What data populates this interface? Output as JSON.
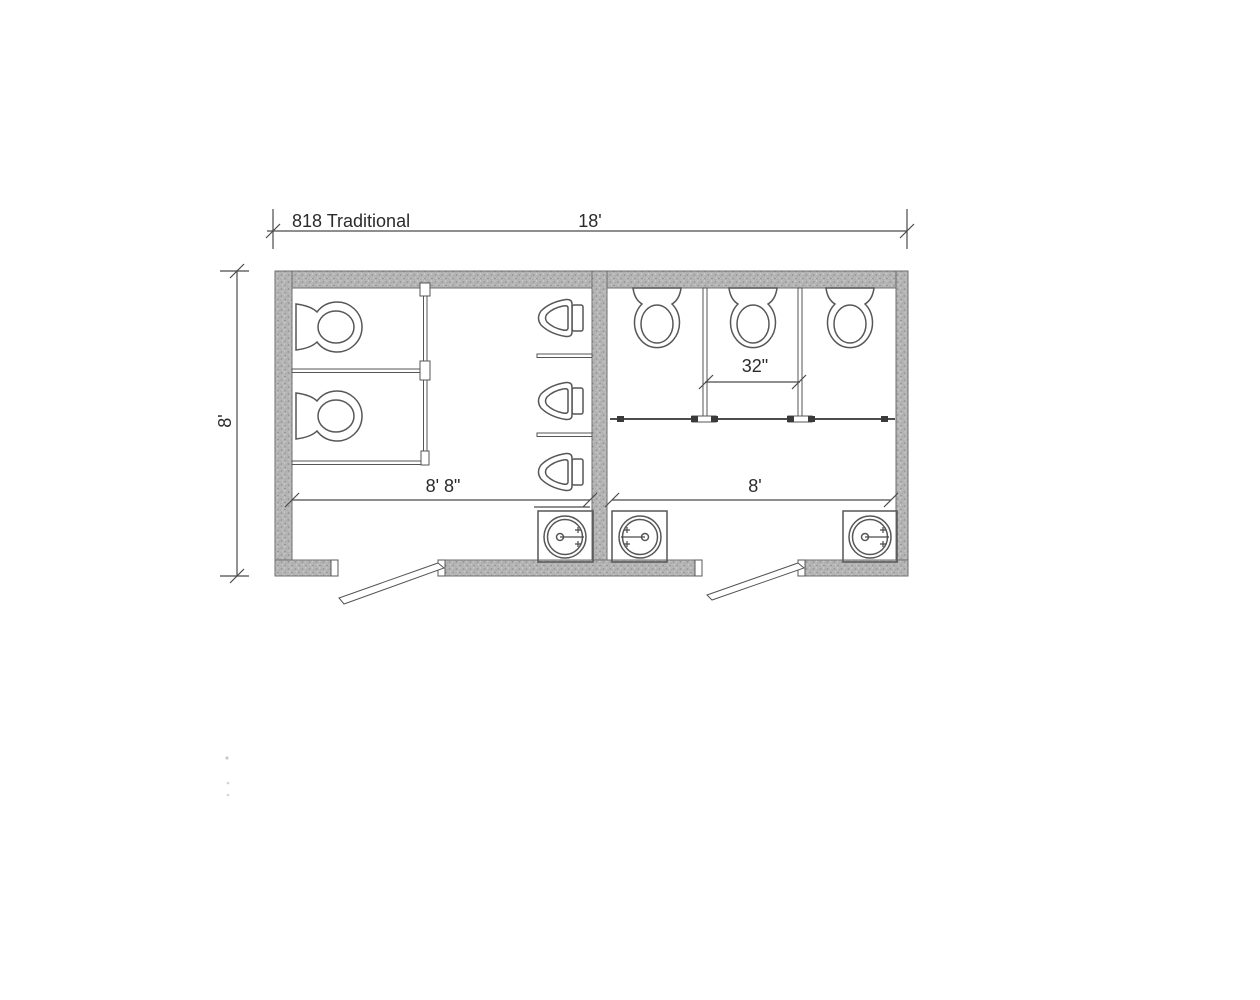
{
  "plan": {
    "title": "818 Traditional",
    "dims": {
      "overall_width": "18'",
      "overall_depth": "8'",
      "left_room_width": "8' 8\"",
      "right_room_width": "8'",
      "stall_width": "32\""
    },
    "rooms": [
      {
        "id": "left-room",
        "width_label": "8' 8\"",
        "toilets": 2,
        "urinals": 3,
        "sinks": 1,
        "doors": 1
      },
      {
        "id": "right-room",
        "width_label": "8'",
        "toilets": 3,
        "urinals": 0,
        "sinks": 2,
        "doors": 1
      }
    ]
  }
}
